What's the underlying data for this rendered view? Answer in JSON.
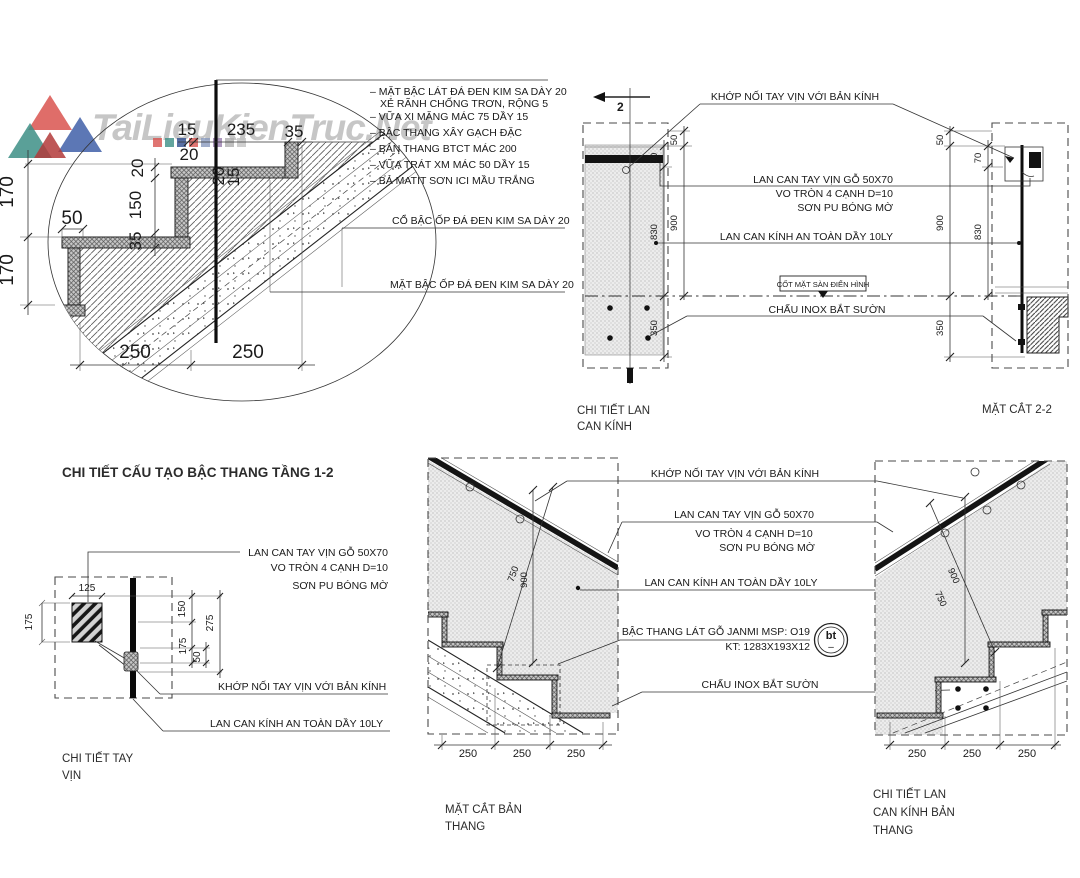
{
  "watermark": {
    "brand": "TaiLieuKienTruc.Net"
  },
  "notes": [
    "– MẶT BẬC LÁT ĐÁ ĐEN KIM SA DÀY 20",
    "XẺ RÃNH CHỐNG TRƠN, RỘNG 5",
    "– VỮA XI MĂNG MÁC 75 DẦY 15",
    "– BẬC THANG XÂY GẠCH ĐẶC",
    "– BẢN THANG BTCT MÁC 200",
    "– VỮA TRÁT XM MÁC 50 DẦY 15",
    "– BẢ MATIT SƠN ICI MẦU TRẮNG"
  ],
  "labels": {
    "co_bac": "CỔ BẬC ỐP ĐÁ ĐEN KIM SA DÀY 20",
    "mat_bac": "MẶT BẬC ỐP ĐÁ ĐEN KIM SA DÀY 20",
    "khop_noi": "KHỚP NỐI TAY VỊN VỚI BẢN KÍNH",
    "tay_vin": "LAN CAN TAY VỊN GỖ 50X70",
    "vo_tron": "VO TRÒN 4 CẠNH D=10",
    "son_pu": "SƠN PU BÓNG MỜ",
    "kinh": "LAN CAN KÍNH AN TOÀN DẦY 10LY",
    "cot_san": "CỐT MẶT SÀN ĐIỂN HÌNH",
    "chau_inox": "CHẤU INOX BẮT SƯỜN",
    "bac_go": "BẬC THANG LÁT GỖ JANMI MSP: O19",
    "kt": "KT: 1283X193X12"
  },
  "titles": {
    "main": "CHI TIẾT CẤU TẠO BẬC THANG TẦNG 1-2",
    "lck1": "CHI TIẾT LAN",
    "lck2": "CAN KÍNH",
    "mc22": "MẶT CẮT 2-2",
    "tv1": "CHI TIẾT TAY",
    "tv2": "VỊN",
    "mcb1": "MẶT CẮT BẢN",
    "mcb2": "THANG",
    "lcb1": "CHI TIẾT LAN",
    "lcb2": "CAN KÍNH BẢN",
    "lcb3": "THANG"
  },
  "marker": {
    "section": "2",
    "bt": "bt",
    "bt_dash": "–"
  },
  "dims": {
    "d15": "15",
    "d20": "20",
    "d35": "35",
    "d50": "50",
    "d70": "70",
    "d125": "125",
    "d150": "150",
    "d170": "170",
    "d175": "175",
    "d235": "235",
    "d250": "250",
    "d275": "275",
    "d350": "350",
    "d750": "750",
    "d830": "830",
    "d900": "900"
  }
}
